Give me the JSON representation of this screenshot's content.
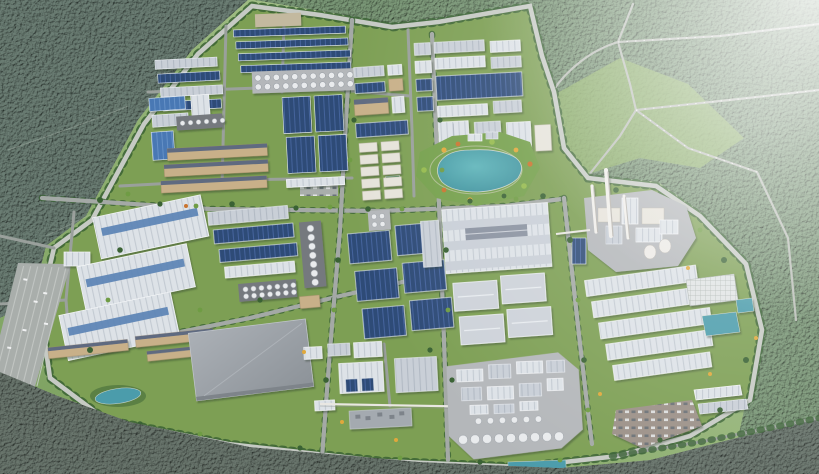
{
  "scene": {
    "type": "aerial-3d-architectural-render",
    "subject": "industrial park master plan surrounded by forest",
    "view": "high-angle bird's-eye view, haze toward the upper-right horizon",
    "environment": {
      "forest_upper_left": "dense dark-green forest",
      "forest_right": "forest with cleared light-green parcels crossed by rural roads with traffic",
      "forest_bottom": "dark forest belt along the foreground",
      "haze": "white atmospheric haze in top-right corner"
    },
    "park": {
      "boundary": "ring road with tree rows enclosing the campus",
      "districts": [
        {
          "id": "north-factory-blocks",
          "content": "rows of navy-roofed sheds, gravel lot, tank farm",
          "tank_count": 22
        },
        {
          "id": "navy-warehouse-grid-north",
          "content": "4 large navy-blue warehouses in a 2x2 grid"
        },
        {
          "id": "north-west-sheds",
          "content": "alternating pale and navy shed rows with silo row"
        },
        {
          "id": "tan-factory-rows",
          "content": "multi-storey tan buildings with dark roofs"
        },
        {
          "id": "lab-block",
          "content": "cream multi-storey buildings in a grid and long navy hall"
        },
        {
          "id": "north-east-block",
          "content": "white halls, pale rows and a large navy solar-panel roof"
        },
        {
          "id": "central-lake-garden",
          "content": "landscaped park with teal lake, paths and colorful shrubs",
          "lake_count": 1
        },
        {
          "id": "center-navy-grid",
          "content": "6 navy warehouses in a 2x3 grid"
        },
        {
          "id": "west-long-rows",
          "content": "pale and navy long warehouses with vertical silo column"
        },
        {
          "id": "logistics-mega-warehouses",
          "content": "3 huge white warehouses with blue skylight stripes",
          "warehouse_count": 3
        },
        {
          "id": "gray-mega-warehouse",
          "content": "single large flat gray warehouse"
        },
        {
          "id": "white-warehouse-complex",
          "content": "striped white warehouse complex and 4 hip-roof halls"
        },
        {
          "id": "south-center-works",
          "content": "white halls, ribbed hall, flat equipment roof, overhead pipe bridge"
        },
        {
          "id": "silo-plant",
          "content": "chemical plant on concrete pad with cylindrical silos",
          "front_silo_count": 9
        },
        {
          "id": "power-plant",
          "content": "cream process plant with tall stacks and cooling towers",
          "chimney_count": 3,
          "cooling_tower_count": 2
        },
        {
          "id": "east-warehouse-rows",
          "content": "long ribbed white warehouses",
          "row_count": 5
        },
        {
          "id": "east-utilities",
          "content": "grid-roof hall and teal water treatment basins",
          "basin_count": 2
        },
        {
          "id": "south-east-parking",
          "content": "brown parking lot filled with cars"
        },
        {
          "id": "west-parking",
          "content": "long striped parking lanes",
          "lane_count": 7
        }
      ]
    }
  },
  "colors": {
    "terrain": "#8fae6d",
    "terrainLight": "#a8c288",
    "forestDark": "#2f5342",
    "forestBottom": "#2b4634",
    "forestRight": "#4d7847",
    "lawn": "#7d9f54",
    "lawnLight": "#8fb166",
    "gardenGreen": "#75a04c",
    "treeDark": "#3a6234",
    "treeLight": "#6f9c44",
    "road": "#a4a9a6",
    "ringRoad": "#c6cac4",
    "roadMinor": "#9aa09c",
    "lot": "#a9aeab",
    "lotBrown": "#9b9087",
    "gravel": "#c3b99f",
    "pad": "#b4b7ba",
    "padDark": "#75797e",
    "roofWhite": "#dde2e7",
    "roofWhiteStripe": "#c3cad2",
    "roofPale": "#c9cfd7",
    "roofPaleStripe": "#b2bac4",
    "roofHip": "#cdd2d9",
    "navy": "#2e4c77",
    "navyStripe": "#45649c",
    "blue": "#4878b4",
    "blueStripe": "#6590c6",
    "skylight": "#5f86b6",
    "tan": "#c8b089",
    "tanRoof": "#5f6b80",
    "cream": "#e6e3da",
    "gray1": "#a4aab0",
    "gray2": "#8f959b",
    "tank": "#e9ebed",
    "tankEdge": "#979da4",
    "lake1": "#5fb5ba",
    "lake2": "#3a8c99",
    "pond": "#4b9cab",
    "white": "#f2f3f4",
    "hazeWhite": "#ffffff",
    "bushYellow": "#e0a83c",
    "bushOrange": "#c9742f",
    "bushLime": "#95ba4d",
    "court": "#3e8450"
  }
}
